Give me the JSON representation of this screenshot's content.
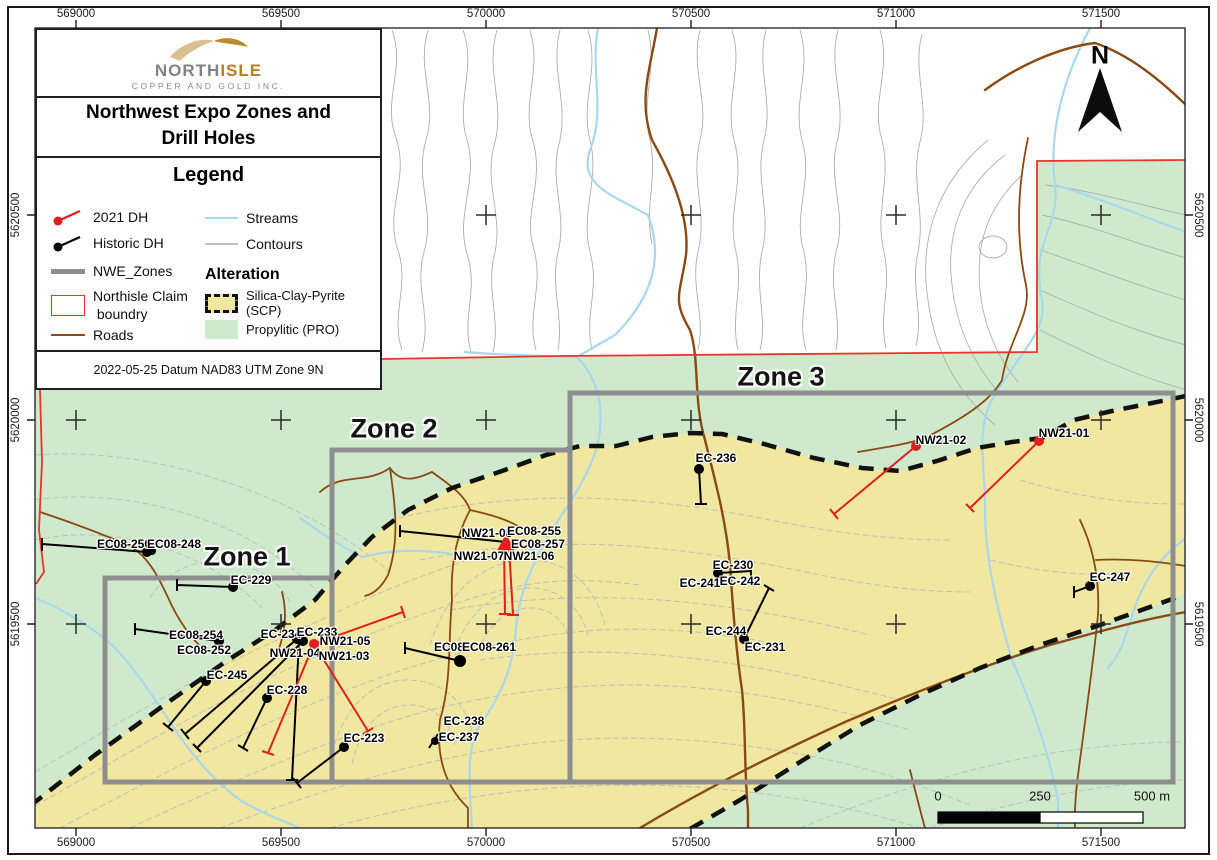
{
  "header": {
    "logo_name_gray": "NORTH",
    "logo_name_gold": "ISLE",
    "logo_subtitle": "COPPER AND GOLD INC.",
    "title_line1": "Northwest Expo Zones and",
    "title_line2": "Drill Holes"
  },
  "legend": {
    "heading": "Legend",
    "items": {
      "dh2021": "2021 DH",
      "dh_historic": "Historic DH",
      "nwe_zones": "NWE_Zones",
      "claim_line1": "Northisle Claim",
      "claim_line2": "boundry",
      "roads": "Roads",
      "streams": "Streams",
      "contours": "Contours"
    },
    "alteration_heading": "Alteration",
    "alteration": {
      "scp": "Silica-Clay-Pyrite (SCP)",
      "pro": "Propylitic (PRO)"
    },
    "footer": "2022-05-25 Datum NAD83 UTM Zone 9N"
  },
  "map": {
    "zone_labels": [
      "Zone 1",
      "Zone 2",
      "Zone 3"
    ],
    "north_label": "N",
    "scale_labels": {
      "zero": "0",
      "mid": "250",
      "end": "500 m"
    },
    "grid": {
      "eastings": [
        "569000",
        "569500",
        "570000",
        "570500",
        "571000",
        "571500"
      ],
      "northings": [
        "5620500",
        "5620000",
        "5619500"
      ]
    },
    "holes": [
      {
        "label": "EC08-250",
        "x": 124,
        "y": 544,
        "type": "historic"
      },
      {
        "label": "EC08-248",
        "x": 174,
        "y": 544,
        "type": "historic"
      },
      {
        "label": "EC-229",
        "x": 251,
        "y": 580,
        "type": "historic"
      },
      {
        "label": "EC08-254",
        "x": 196,
        "y": 635,
        "type": "historic"
      },
      {
        "label": "EC08-252",
        "x": 204,
        "y": 650,
        "type": "historic"
      },
      {
        "label": "EC-245",
        "x": 227,
        "y": 675,
        "type": "historic"
      },
      {
        "label": "EC-234",
        "x": 281,
        "y": 634,
        "type": "historic"
      },
      {
        "label": "EC-233",
        "x": 317,
        "y": 632,
        "type": "historic"
      },
      {
        "label": "NW21-05",
        "x": 345,
        "y": 641,
        "type": "2021"
      },
      {
        "label": "NW21-04",
        "x": 295,
        "y": 653,
        "type": "2021"
      },
      {
        "label": "NW21-03",
        "x": 344,
        "y": 656,
        "type": "2021"
      },
      {
        "label": "EC-228",
        "x": 287,
        "y": 690,
        "type": "historic"
      },
      {
        "label": "EC-223",
        "x": 364,
        "y": 738,
        "type": "historic"
      },
      {
        "label": "EC-238",
        "x": 464,
        "y": 721,
        "type": "historic"
      },
      {
        "label": "EC-237",
        "x": 459,
        "y": 737,
        "type": "historic"
      },
      {
        "label": "NW21-08",
        "x": 487,
        "y": 533,
        "type": "2021"
      },
      {
        "label": "EC08-255",
        "x": 534,
        "y": 531,
        "type": "historic"
      },
      {
        "label": "EC08-257",
        "x": 538,
        "y": 544,
        "type": "historic"
      },
      {
        "label": "NW21-07",
        "x": 479,
        "y": 556,
        "type": "2021"
      },
      {
        "label": "NW21-06",
        "x": 529,
        "y": 556,
        "type": "2021"
      },
      {
        "label": "EC08",
        "x": 449,
        "y": 647,
        "type": "historic"
      },
      {
        "label": "EC08-261",
        "x": 489,
        "y": 647,
        "type": "historic"
      },
      {
        "label": "EC-236",
        "x": 716,
        "y": 458,
        "type": "historic"
      },
      {
        "label": "EC-230",
        "x": 733,
        "y": 565,
        "type": "historic"
      },
      {
        "label": "EC-241",
        "x": 700,
        "y": 583,
        "type": "historic"
      },
      {
        "label": "EC-242",
        "x": 740,
        "y": 581,
        "type": "historic"
      },
      {
        "label": "EC-244",
        "x": 726,
        "y": 631,
        "type": "historic"
      },
      {
        "label": "EC-231",
        "x": 765,
        "y": 647,
        "type": "historic"
      },
      {
        "label": "NW21-02",
        "x": 941,
        "y": 440,
        "type": "2021"
      },
      {
        "label": "NW21-01",
        "x": 1064,
        "y": 433,
        "type": "2021"
      },
      {
        "label": "EC-247",
        "x": 1110,
        "y": 577,
        "type": "historic"
      }
    ]
  },
  "colors": {
    "propylitic_green": "#cfe9cd",
    "scp_yellow": "#f0e7a0",
    "stream_blue": "#a9d7ee",
    "road_brown": "#8a4a12",
    "zone_outline_gray": "#8e8e8e",
    "claim_red": "#e8352b",
    "dh_2021_red": "#e01f1f",
    "dh_historic_black": "#000000"
  }
}
